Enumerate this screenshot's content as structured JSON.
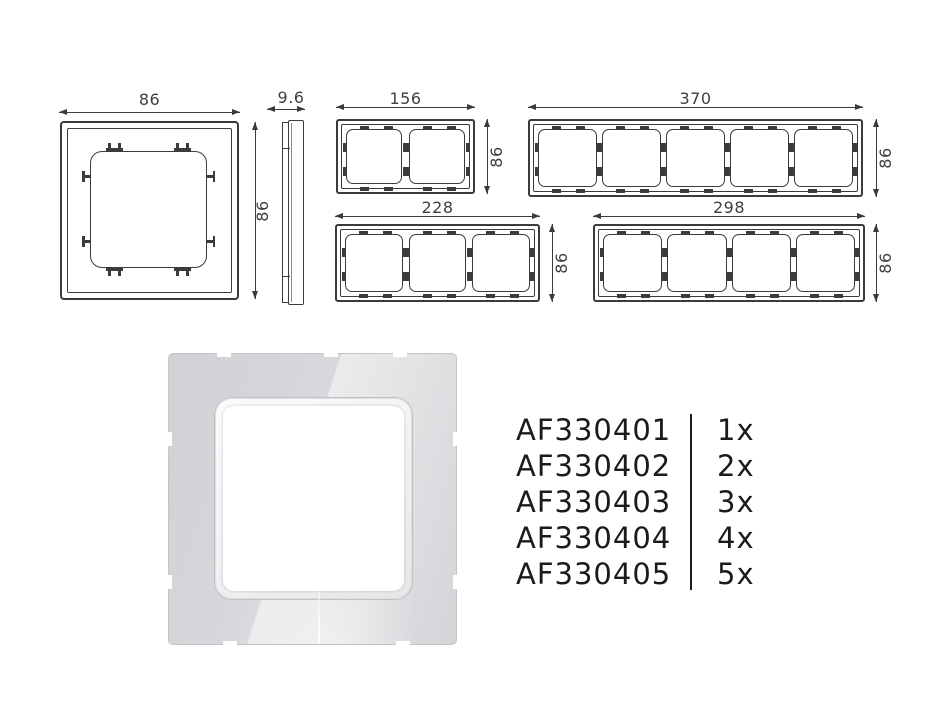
{
  "drawings": {
    "single_front": {
      "width_label": "86",
      "height_label": "86"
    },
    "side_profile": {
      "depth_label": "9.6"
    },
    "gang2": {
      "width_label": "156",
      "height_label": "86"
    },
    "gang5": {
      "width_label": "370",
      "height_label": "86"
    },
    "gang3": {
      "width_label": "228",
      "height_label": "86"
    },
    "gang4": {
      "width_label": "298",
      "height_label": "86"
    }
  },
  "product_list": {
    "items": [
      {
        "sku": "AF330401",
        "qty": "1x"
      },
      {
        "sku": "AF330402",
        "qty": "2x"
      },
      {
        "sku": "AF330403",
        "qty": "3x"
      },
      {
        "sku": "AF330404",
        "qty": "4x"
      },
      {
        "sku": "AF330405",
        "qty": "5x"
      }
    ]
  },
  "colors": {
    "line": "#3b3b3b",
    "list_text": "#1b1b1b",
    "render_frame": "#d4d6d9",
    "render_pane": "#ffffff",
    "background": "#ffffff"
  }
}
